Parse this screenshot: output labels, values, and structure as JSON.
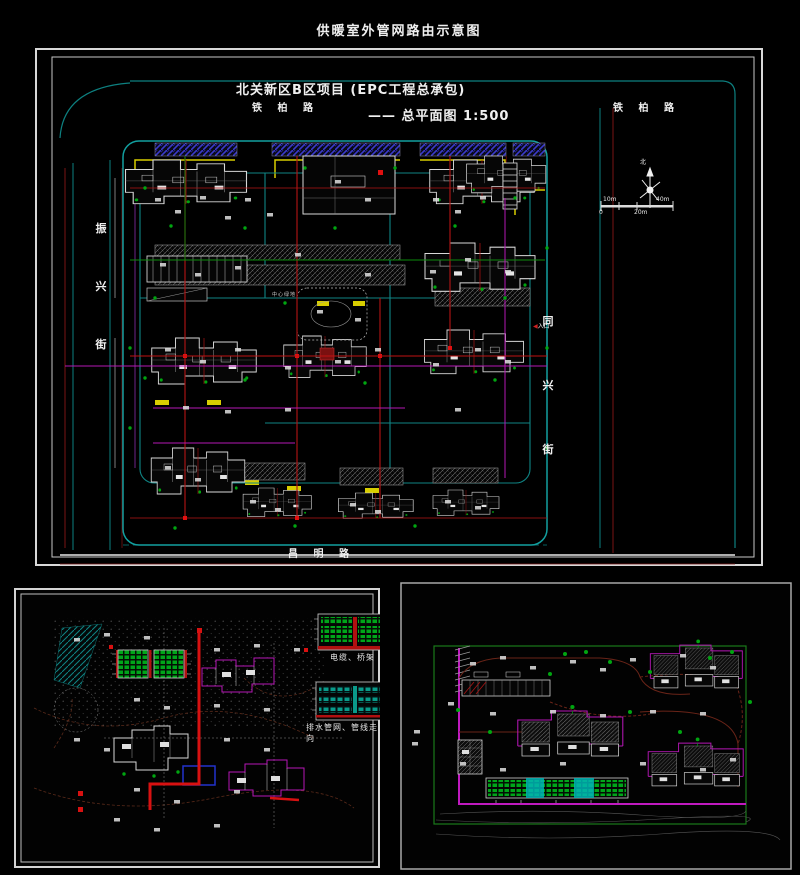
{
  "header": {
    "title": "供暖室外管网路由示意图"
  },
  "site_plan": {
    "project_title": "北关新区B区项目 (EPC工程总承包)",
    "plan_title": "—— 总平面图 1:500",
    "roads": {
      "tiebai_left": "铁 柏 路",
      "tiebai_right": "铁 柏 路",
      "zhenxing_street": "振兴街",
      "tongxing_street": "同兴街",
      "changming_road": "昌 明 路"
    },
    "labels": {
      "north": "北",
      "entrance_arrow": "◀",
      "entrance": "入口",
      "center_green": "中心绿地"
    },
    "scale_bar": {
      "zero": "0",
      "ten": "10m",
      "twenty": "20m",
      "forty": "40m"
    }
  },
  "detail_left": {
    "legend_cable": "电缆、桥架",
    "legend_drain": "排水管网、管线走向"
  },
  "colors": {
    "background": "#000000",
    "frame": "#d9d9d9",
    "road_teal": "#0d8080",
    "boundary_cyan": "#12a0a0",
    "pipe_red": "#c01212",
    "deep_red": "#7a1515",
    "accent_yellow": "#d8ce00",
    "line_magenta": "#b517b5",
    "tree_green": "#00a510",
    "hatch_blue": "#3a3acc",
    "building_white": "#d8d8d8",
    "legend_green": "#00a51a"
  }
}
